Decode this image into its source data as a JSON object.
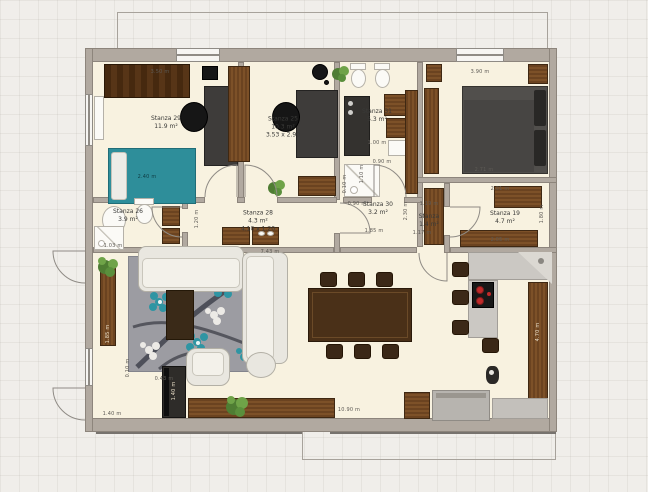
{
  "plan": {
    "rooms": {
      "r29": {
        "name": "Stanza 29",
        "area": "11.9 m²"
      },
      "r25": {
        "name": "Stanza 25",
        "area": "10.3 m²",
        "size": "3.53 x 2.90"
      },
      "r31": {
        "name": "Stanza 31",
        "area": "5.3 m²"
      },
      "r26": {
        "name": "Stanza 26",
        "area": "3.9 m²"
      },
      "r28": {
        "name": "Stanza 28",
        "area": "4.3 m²",
        "size": "4.10 x 1.20"
      },
      "r30": {
        "name": "Stanza 30",
        "area": "3.2 m²"
      },
      "closet": {
        "name": "Stanza",
        "area": "1.4 m²"
      },
      "r19": {
        "name": "Stanza 19",
        "area": "4.7 m²"
      }
    },
    "dims": {
      "d1": "3.50 m",
      "d2": "2.40 m",
      "d3": "1.00 m",
      "d4": "0.90 m",
      "d5": "1.10 m",
      "d6": "0.10 m",
      "d7": "3.90 m",
      "d8": "2.71 m",
      "d9": "2.01 m",
      "d10": "2.05 m",
      "d11": "1.80 m",
      "d12": "1.19 m",
      "d13": "1.17 m",
      "d14": "0.90 m",
      "d15": "1.85 m",
      "d16": "2.30 m",
      "d17": "7.43 m",
      "d18": "1.20 m",
      "d19": "1.40 m",
      "d20": "1.40 m",
      "d21": "0.43 m",
      "d22": "0.10 m",
      "d23": "10.90 m",
      "d24": "4.70 m",
      "d25": "1.85 m",
      "d26": "1.03 m"
    },
    "colors": {
      "wall": "#b1a9a0",
      "floor": "#f8f2e0",
      "wood": "#6e451f",
      "teal_bed": "#2e8e9a",
      "rug": "#9c9ca2",
      "counter": "#cbc8c3",
      "burner_red": "#c02a2a"
    }
  }
}
